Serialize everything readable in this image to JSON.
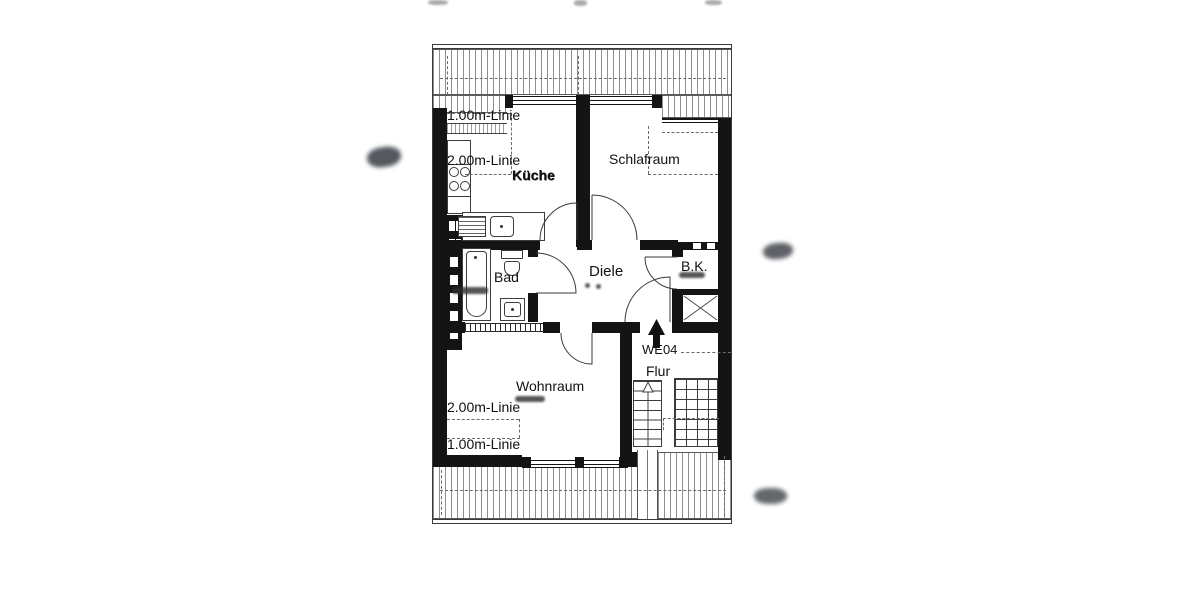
{
  "plan": {
    "labels": {
      "line_1m_top": "1.00m-Linie",
      "line_2m_top": "2.00m-Linie",
      "kitchen": "Küche",
      "bedroom": "Schlafraum",
      "bath": "Bad",
      "hall": "Diele",
      "storage": "B.K.",
      "unit": "WE04",
      "corridor": "Flur",
      "living": "Wohnraum",
      "line_2m_bottom": "2.00m-Linie",
      "line_1m_bottom": "1.00m-Linie"
    },
    "colors": {
      "wall": "#141414",
      "hatch": "#8f8f8f",
      "text": "#111111",
      "background": "#ffffff"
    }
  }
}
